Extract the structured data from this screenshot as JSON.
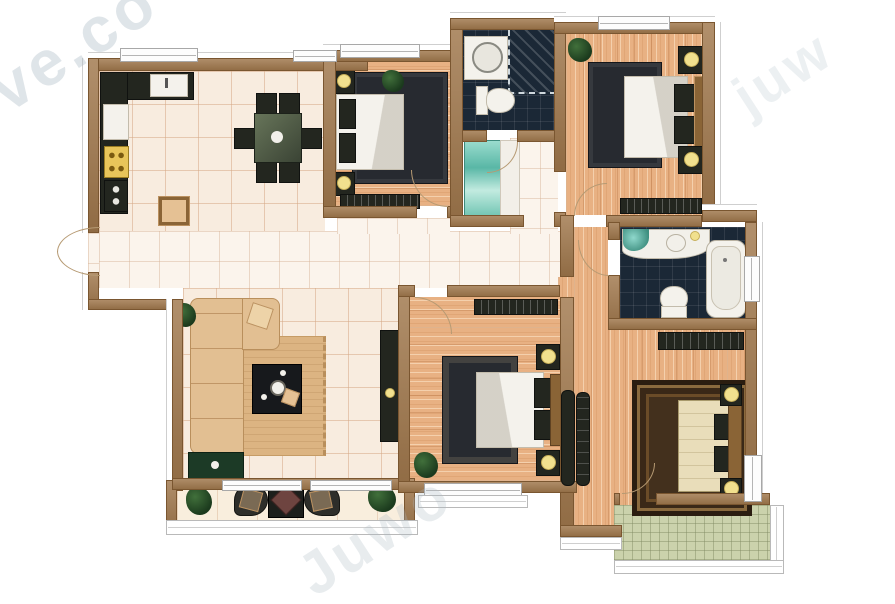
{
  "meta": {
    "type": "apartment-floor-plan",
    "canvas": {
      "width": 895,
      "height": 604
    },
    "labels_visible": false
  },
  "watermarks": {
    "top_left": "ve.co",
    "top_right": "juw",
    "bottom": "Juwo"
  },
  "palette": {
    "wall": "#a0774b",
    "wall_edge": "#7a5630",
    "wood_floor": "#e8b183",
    "tile_floor": "#f8ecdf",
    "hall_tile": "#fbf4ec",
    "bath_tile": "#1b2836",
    "green_balcony_tile": "#cbd2ac",
    "furniture_dark": "#23261f",
    "rug_dark": "#272a30",
    "master_rug": "#43301d",
    "bed_white": "#f4f2ec",
    "sofa_tan": "#e2bf92",
    "lamp_yellow": "#f1e08e",
    "teal_cabinet": "#7fd0c2",
    "plant_green": "#2a4a28",
    "stove_yellow": "#e8c55a"
  },
  "rooms": [
    {
      "name": "kitchen",
      "floor": "tile",
      "furniture": [
        "l-shaped-counter",
        "sink",
        "refrigerator",
        "stove",
        "oven",
        "island"
      ]
    },
    {
      "name": "dining-area",
      "floor": "tile",
      "furniture": [
        "dining-table",
        "six-chairs"
      ]
    },
    {
      "name": "bedroom-top-middle",
      "floor": "wood",
      "furniture": [
        "double-bed",
        "rug",
        "nightstand-x2",
        "lamp-x2",
        "dresser",
        "plant"
      ]
    },
    {
      "name": "bathroom-top",
      "floor": "dark-tile",
      "furniture": [
        "washing-machine",
        "shower-corner",
        "toilet"
      ]
    },
    {
      "name": "bedroom-top-right",
      "floor": "wood",
      "furniture": [
        "double-bed",
        "rug",
        "nightstand-x2",
        "lamp-x2",
        "dresser",
        "plant"
      ]
    },
    {
      "name": "hallway",
      "floor": "tile",
      "furniture": [
        "display-cabinet-teal",
        "shelf"
      ]
    },
    {
      "name": "living-room",
      "floor": "tile",
      "furniture": [
        "corner-sofa",
        "throw-pillow",
        "rug",
        "coffee-table",
        "tv-console",
        "plant-x2"
      ]
    },
    {
      "name": "bathroom-right",
      "floor": "dark-tile",
      "furniture": [
        "vanity-sink",
        "toilet",
        "bathtub"
      ]
    },
    {
      "name": "bedroom-bottom-middle",
      "floor": "wood",
      "furniture": [
        "double-bed",
        "rug",
        "nightstand-x2",
        "lamp-x2",
        "dresser",
        "wardrobe",
        "plant",
        "bay-window"
      ]
    },
    {
      "name": "master-bedroom",
      "floor": "wood",
      "furniture": [
        "double-bed",
        "ornate-rug",
        "nightstand-x2",
        "lamp-x2",
        "dresser",
        "wardrobe"
      ]
    },
    {
      "name": "balcony-bottom-left",
      "floor": "tile",
      "furniture": [
        "chair-x2",
        "side-table",
        "plant-x2",
        "railing"
      ]
    },
    {
      "name": "balcony-bottom-right",
      "floor": "green-tile",
      "furniture": [
        "railing"
      ]
    }
  ],
  "doors": [
    "entrance-double-door",
    "bedroom-top-middle-door",
    "bathroom-top-door",
    "bedroom-top-right-door",
    "bathroom-right-door",
    "bedroom-bottom-middle-door",
    "balcony-right-door"
  ],
  "windows": [
    "kitchen-window-x2",
    "bedroom-top-middle-window",
    "bedroom-top-right-window",
    "balcony-window-x2",
    "bay-window",
    "bathtub-window",
    "master-window"
  ]
}
